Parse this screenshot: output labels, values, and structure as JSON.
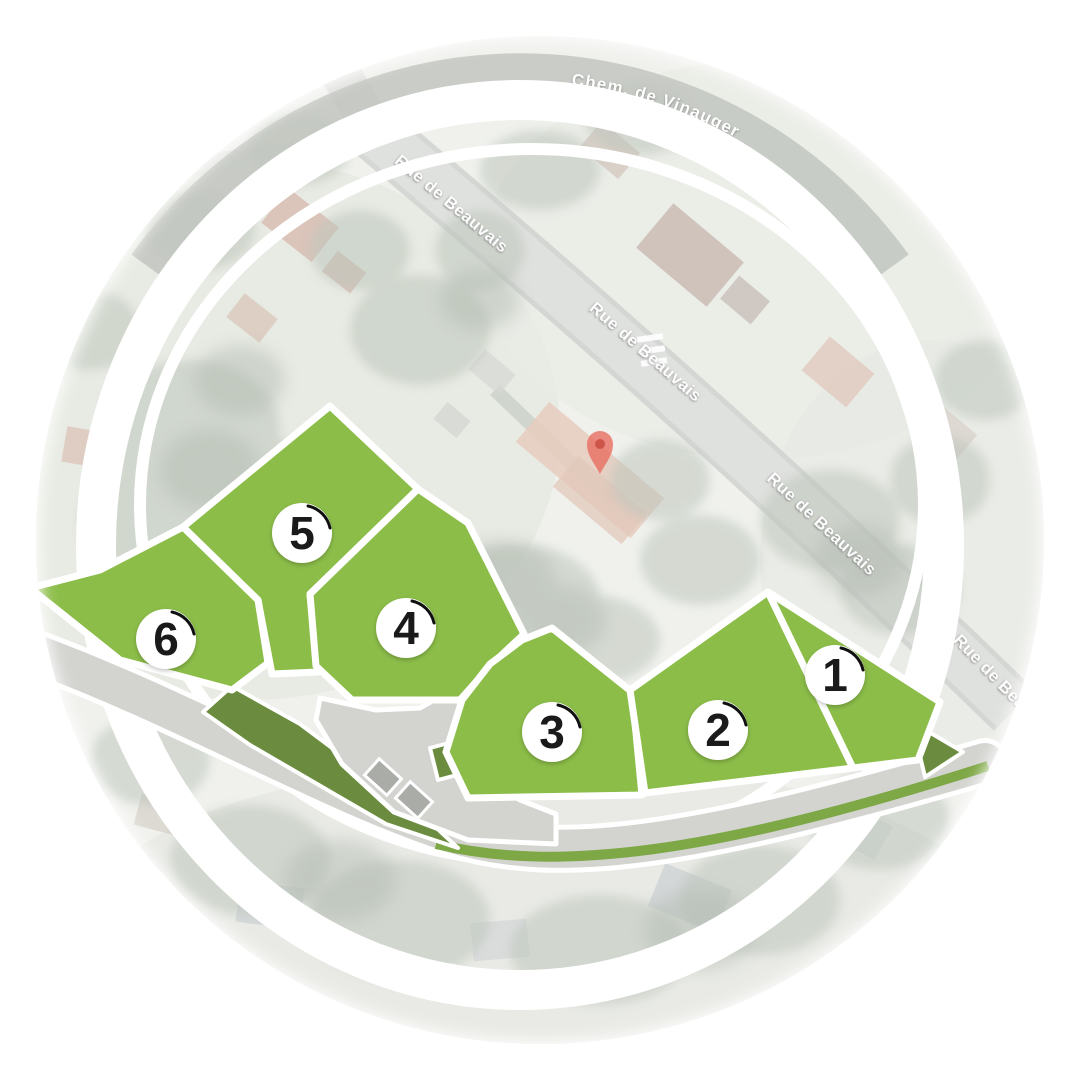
{
  "map": {
    "streets": {
      "top_curved": "Chem. de Vinauger",
      "main_road_labels": [
        "Rue de Beauvais",
        "Rue de Beauvais",
        "Rue de Beauvais"
      ],
      "edge_partial": "Rue de Beauvais"
    },
    "plots": [
      {
        "number": "1"
      },
      {
        "number": "2"
      },
      {
        "number": "3"
      },
      {
        "number": "4"
      },
      {
        "number": "5"
      },
      {
        "number": "6"
      }
    ],
    "pin": {
      "name": "location-pin"
    },
    "colors": {
      "plot_green": "#8cbd49",
      "dark_green": "#6b8c3e",
      "strip_green": "#7ea746",
      "road_gray": "#d3d4d0",
      "parking_gray": "#aaaca8",
      "ring_white": "#ffffff",
      "badge_bg": "#ffffff",
      "badge_text": "#1a1a1a",
      "pin_red": "#e96e60",
      "pin_core": "#c74e41"
    }
  }
}
